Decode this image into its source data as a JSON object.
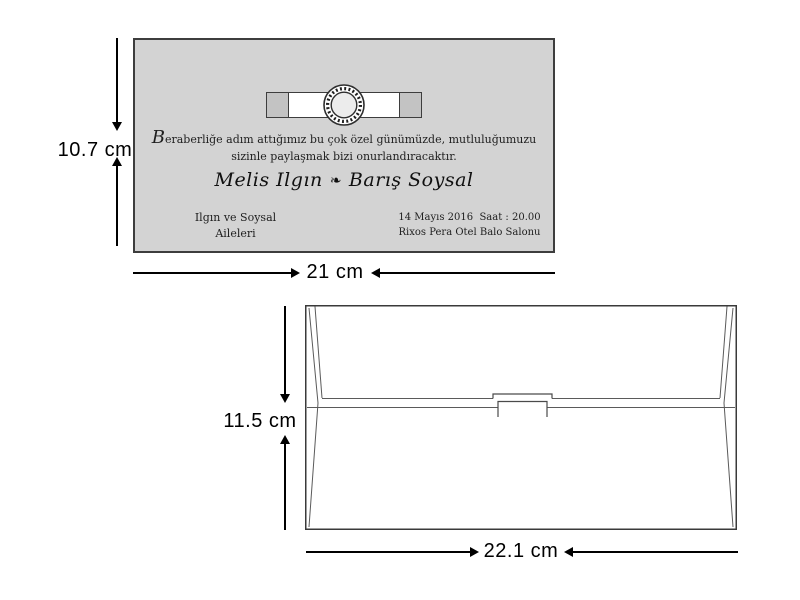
{
  "card": {
    "background": "#d3d3d3",
    "border_color": "#3d3d3d",
    "ribbon": {
      "band_color": "#ffffff",
      "cap_color": "#c3c3c3"
    },
    "message": {
      "line1_initial": "B",
      "line1_rest": "eraberliğe adım attığımız bu çok özel günümüzde, mutluluğumuzu",
      "line2": "sizinle paylaşmak bizi onurlandıracaktır."
    },
    "names": {
      "bride": "Melis Ilgın",
      "ornament": "❧",
      "groom": "Barış Soysal"
    },
    "hosts": {
      "line1": "Ilgın ve Soysal",
      "line2": "Aileleri"
    },
    "event": {
      "line1": "14 Mayıs 2016  Saat : 20.00",
      "line2": "Rixos Pera Otel Balo Salonu"
    }
  },
  "envelope": {
    "fill": "#ffffff",
    "outline_color": "#4a4a4a"
  },
  "dimensions": {
    "card_height": "10.7 cm",
    "card_width": "21 cm",
    "envelope_height": "11.5 cm",
    "envelope_width": "22.1 cm"
  },
  "colors": {
    "page_background": "#ffffff",
    "dimension_lines": "#000000"
  }
}
